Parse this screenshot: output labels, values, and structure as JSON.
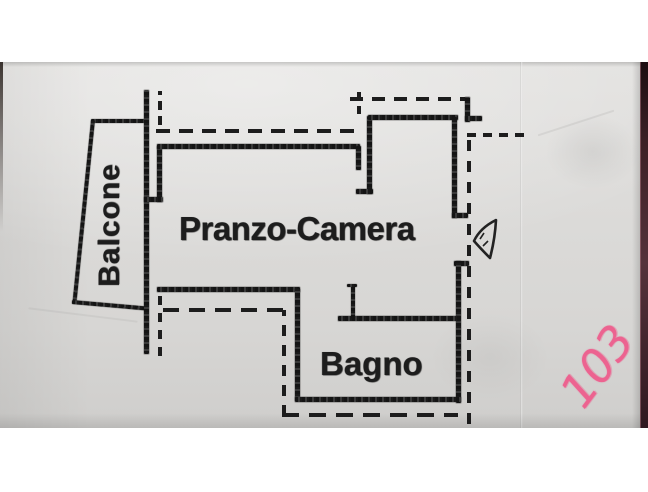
{
  "floor_plan": {
    "rooms": [
      {
        "id": "balcone",
        "label": "Balcone"
      },
      {
        "id": "pranzo_camera",
        "label": "Pranzo-Camera"
      },
      {
        "id": "bagno",
        "label": "Bagno"
      }
    ],
    "handwritten_number": "103",
    "colors": {
      "ink": "#1d1d1d",
      "paper": "#dcdbd9",
      "background": "#ffffff",
      "table_edge": "#55323b",
      "marker_pink": "#ec6390"
    }
  }
}
